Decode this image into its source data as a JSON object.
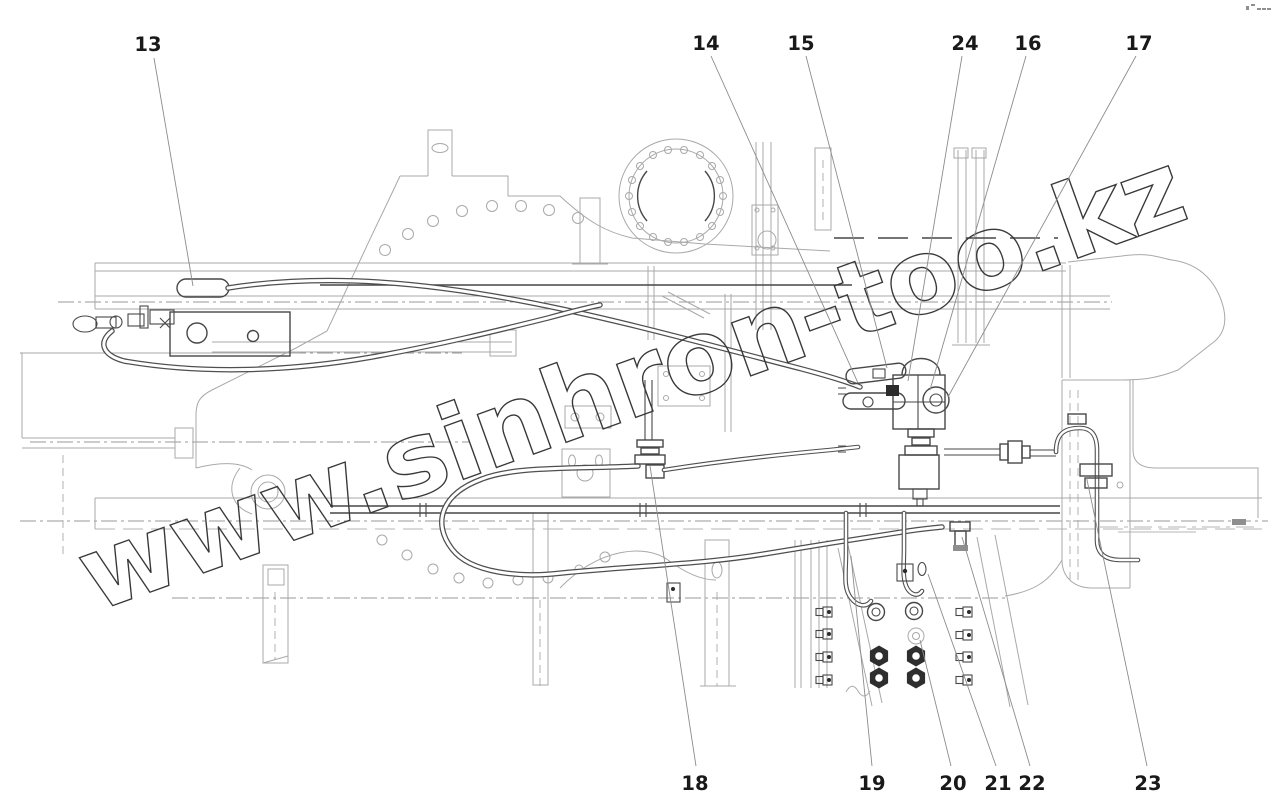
{
  "figure": {
    "watermark": "www.sinhron-too.kz"
  },
  "callouts": {
    "c13": "13",
    "c14": "14",
    "c15": "15",
    "c16": "16",
    "c17": "17",
    "c18": "18",
    "c19": "19",
    "c20": "20",
    "c21": "21",
    "c22": "22",
    "c23": "23",
    "c24": "24"
  }
}
